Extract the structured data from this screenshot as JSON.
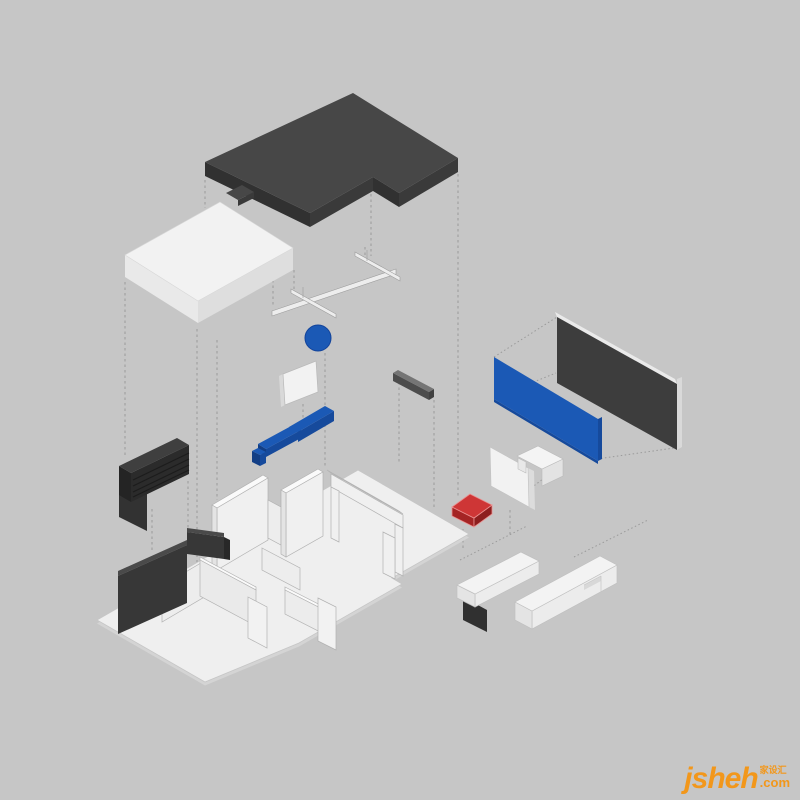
{
  "watermark": {
    "brand": "jsheh",
    "tld": ".com",
    "cjk": "家设汇",
    "color": "#f2971b"
  },
  "palette": {
    "bg": "#c6c6c6",
    "wm": "#f2971b",
    "guide": "#9a9a9a",
    "dark_top": "#474747",
    "dark_side": "#3a3a3a",
    "dark_side2": "#313131",
    "slab_top": "#f2f2f2",
    "slab_sw": "#e9e9e9",
    "slab_se": "#dedede",
    "plate": "#efefef",
    "plate_edge": "#d4d4d4",
    "plate_stroke": "#c6c6c6",
    "wall_face": "#f0f0f0",
    "wall_side": "#e4e4e4",
    "wall_top": "#fafafa",
    "wall_stroke": "#b2b2b2",
    "blue": "#1b59b5",
    "blue_dark": "#164a9c",
    "blue_darker": "#123e85",
    "red_top": "#ce3636",
    "red_sw": "#a42424",
    "red_se": "#8d1e1e",
    "red_hi": "#ea9090",
    "beam_top": "#757575",
    "beam_side": "#4c4c4c",
    "beam_end": "#414141",
    "cab_top": "#3f3f3f",
    "cab_face": "#2b2b2b",
    "cab_side": "#242424",
    "cab_slat": "#1c1c1c",
    "cab_panel": "#323232",
    "dwall_top": "#4a4a4a",
    "dwall_face": "#373737",
    "dwall_side": "#282828",
    "media_face": "#3d3d3d",
    "media_frame": "#eaeaea",
    "media_frame2": "#d9d9d9",
    "fixture": "#ededed",
    "fixture_stroke": "#9c9c9c",
    "bench_dark": "#303030"
  },
  "elements": [
    {
      "id": "roof-slab",
      "desc": "dark L-shaped roof slab"
    },
    {
      "id": "ceiling-slab",
      "desc": "white ceiling slab"
    },
    {
      "id": "track-light",
      "desc": "ceiling track light fixture"
    },
    {
      "id": "pendant-light",
      "desc": "blue sphere pendant light"
    },
    {
      "id": "wall-art-panel",
      "desc": "small white wall panel"
    },
    {
      "id": "blue-console",
      "desc": "blue stepped console unit"
    },
    {
      "id": "slatted-cabinet",
      "desc": "dark slatted cabinet"
    },
    {
      "id": "dark-partition-wall",
      "desc": "dark partition wall"
    },
    {
      "id": "gray-beam",
      "desc": "small gray beam"
    },
    {
      "id": "media-wall",
      "desc": "dark framed media wall panel"
    },
    {
      "id": "accent-wall",
      "desc": "blue accent wall panel"
    },
    {
      "id": "tv-panel",
      "desc": "white tv panel"
    },
    {
      "id": "wall-bracket",
      "desc": "white wall bracket"
    },
    {
      "id": "red-cabinet",
      "desc": "red floating cabinet"
    },
    {
      "id": "floor-plan",
      "desc": "white apartment floor model with walls and doors"
    },
    {
      "id": "bench-low",
      "desc": "white bench with dark niche"
    },
    {
      "id": "bench-long",
      "desc": "long white storage bench"
    }
  ]
}
